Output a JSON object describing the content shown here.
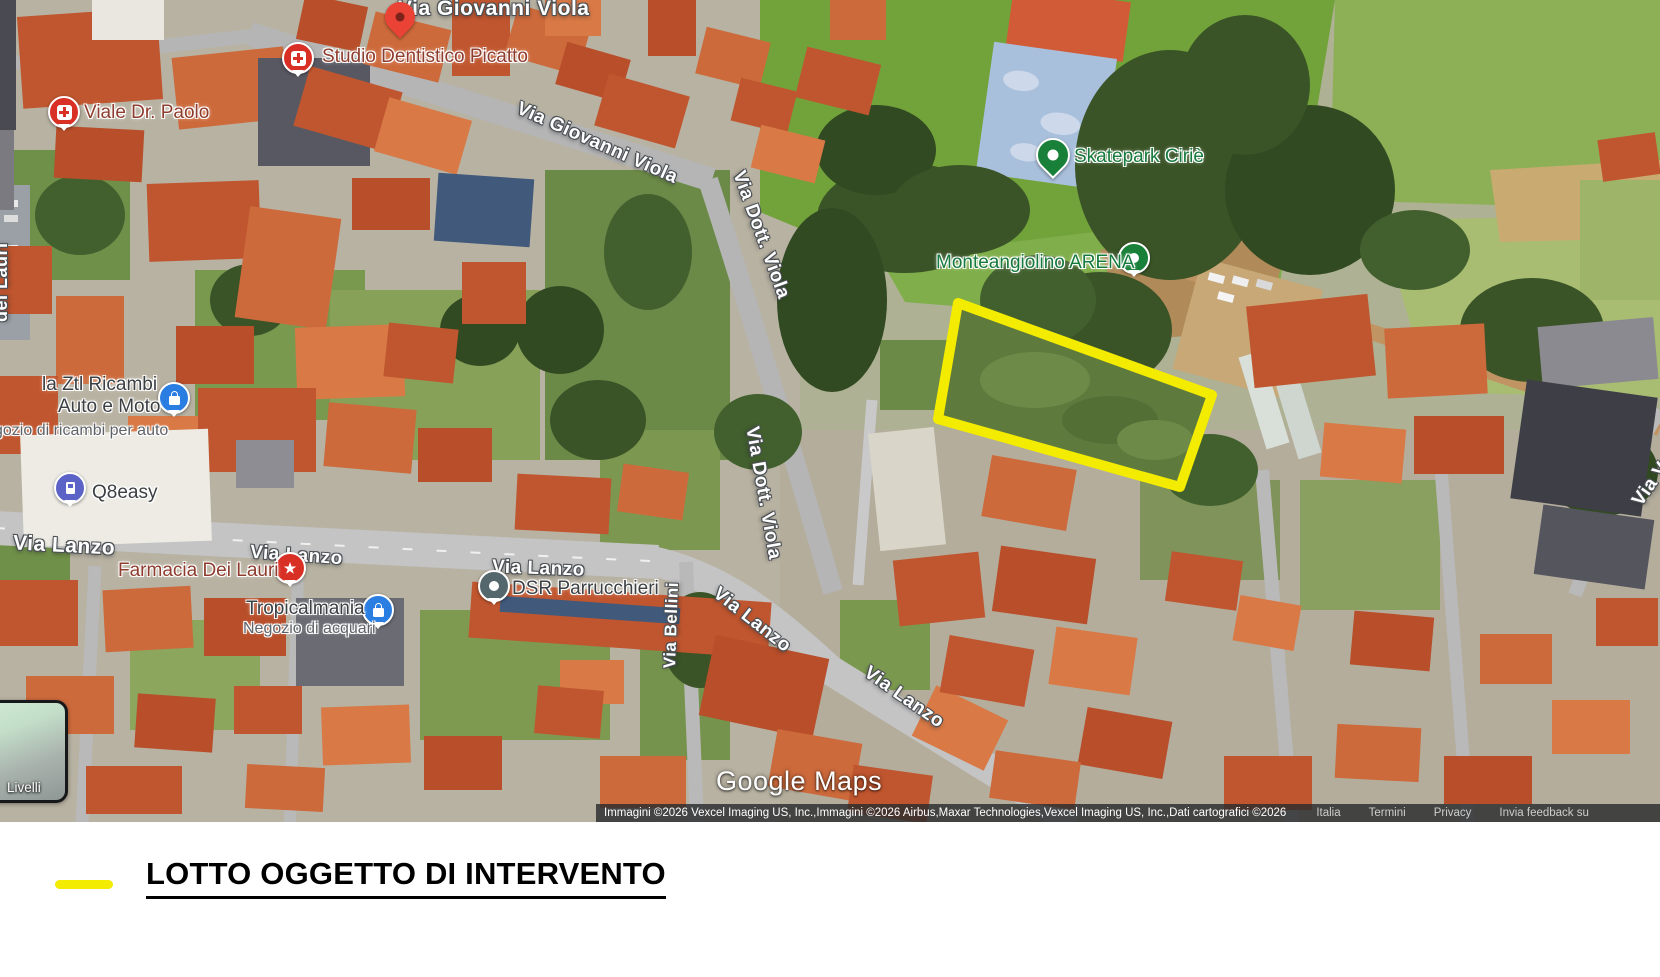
{
  "map": {
    "street_labels": {
      "via_giovanni_viola_top": "Via Giovanni Viola",
      "via_giovanni_viola_diag": "Via Giovanni Viola",
      "via_dott_viola_upper": "Via Dott. Viola",
      "via_dott_viola_lower": "Via Dott. Viola",
      "via_lanzo_w": "Via Lanzo",
      "via_lanzo_center": "Via Lanzo",
      "via_lanzo_mid": "Via Lanzo",
      "via_lanzo_diag": "Via Lanzo",
      "via_lanzo_se": "Via Lanzo",
      "via_bellini": "Via Bellini",
      "dei_lauri_partial": "dei Lauri",
      "via_va_partial": "Via Va"
    },
    "pois": {
      "studio_dentistico": "Studio Dentistico Picatto",
      "viale_dr_paolo": "Viale Dr. Paolo",
      "skatepark": "Skatepark Ciriè",
      "monteangiolino": "Monteangiolino ARENA",
      "ztl_line1": "la Ztl Ricambi",
      "ztl_line2": "Auto e Moto",
      "ztl_sub": "gozio di ricambi per auto",
      "q8easy": "Q8easy",
      "farmacia": "Farmacia Dei Lauri",
      "tropicalmania": "Tropicalmania",
      "tropicalmania_sub": "Negozio di acquari",
      "dsr": "DSR Parrucchieri"
    },
    "watermark": "Google Maps",
    "attribution": {
      "credits": "Immagini ©2026 Vexcel Imaging US, Inc.,Immagini ©2026 Airbus,Maxar Technologies,Vexcel Imaging US, Inc.,Dati cartografici ©2026",
      "links": [
        "Italia",
        "Termini",
        "Privacy",
        "Invia feedback su"
      ]
    },
    "layers_control": "Livelli",
    "highlight_color": "#f3ec00"
  },
  "legend": {
    "label": "LOTTO OGGETTO DI INTERVENTO",
    "line_color": "#f3ec00"
  }
}
